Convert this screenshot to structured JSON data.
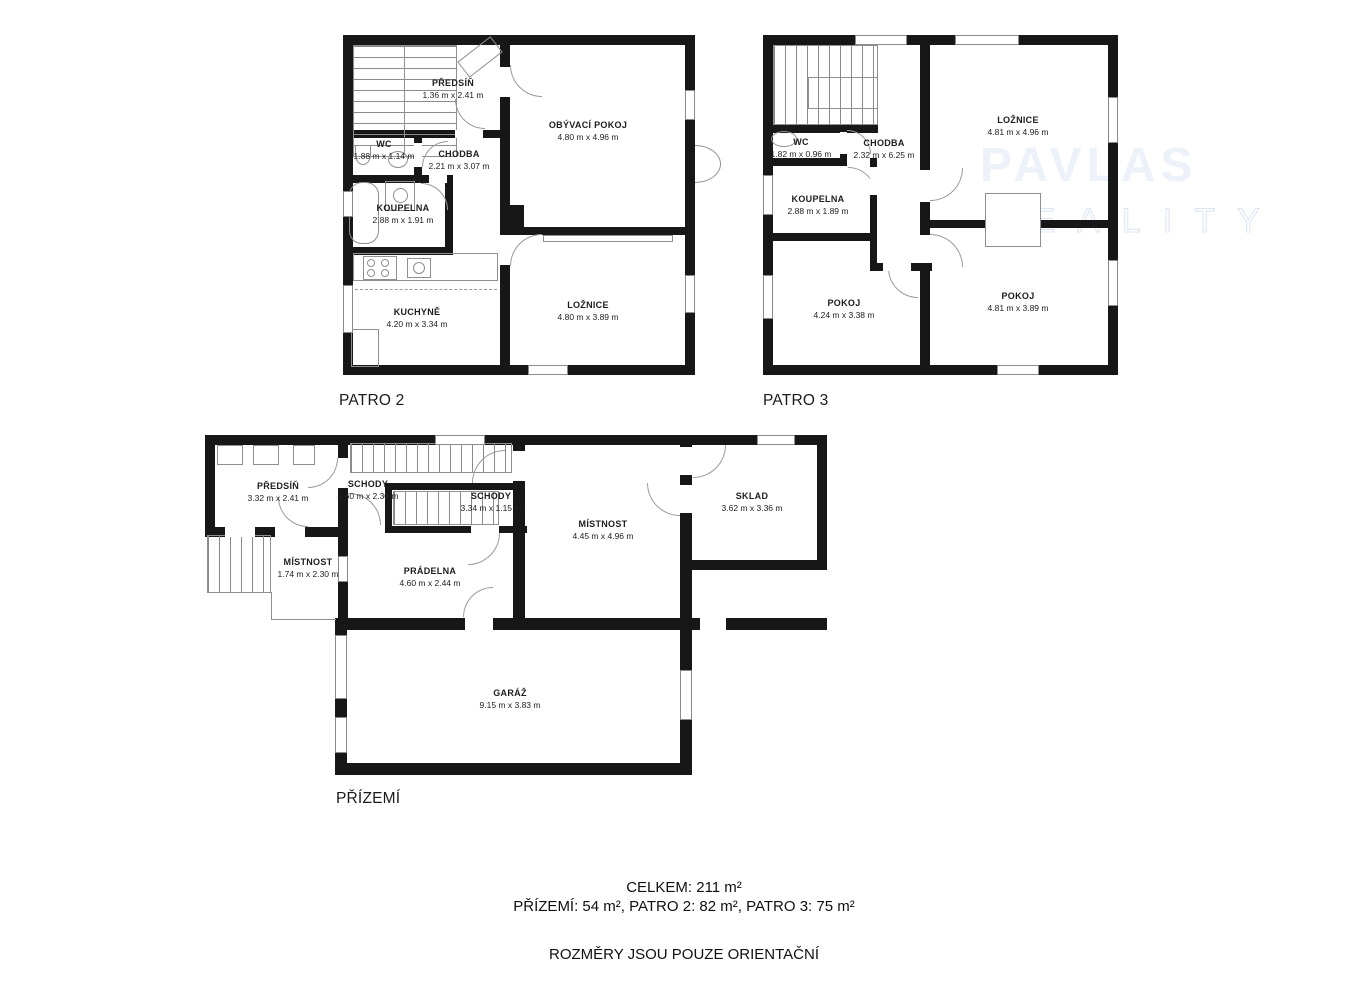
{
  "floors": [
    {
      "label": "PATRO 2",
      "rooms": [
        {
          "name": "PŘEDSÍŇ",
          "dims": "1.36 m x 2.41 m"
        },
        {
          "name": "WC",
          "dims": "1.88 m x 1.14 m"
        },
        {
          "name": "CHODBA",
          "dims": "2.21 m x 3.07 m"
        },
        {
          "name": "KOUPELNA",
          "dims": "2.88 m x 1.91 m"
        },
        {
          "name": "KUCHYNĚ",
          "dims": "4.20 m x 3.34 m"
        },
        {
          "name": "OBÝVACÍ POKOJ",
          "dims": "4.80 m x 4.96 m"
        },
        {
          "name": "LOŽNICE",
          "dims": "4.80 m x 3.89 m"
        }
      ]
    },
    {
      "label": "PATRO 3",
      "rooms": [
        {
          "name": "WC",
          "dims": "1.82 m x 0.96 m"
        },
        {
          "name": "CHODBA",
          "dims": "2.32 m x 6.25 m"
        },
        {
          "name": "KOUPELNA",
          "dims": "2.88 m x 1.89 m"
        },
        {
          "name": "LOŽNICE",
          "dims": "4.81 m x 4.96 m"
        },
        {
          "name": "POKOJ",
          "dims": "4.24 m x 3.38 m"
        },
        {
          "name": "POKOJ",
          "dims": "4.81 m x 3.89 m"
        }
      ]
    },
    {
      "label": "PŘÍZEMÍ",
      "rooms": [
        {
          "name": "PŘEDSÍŇ",
          "dims": "3.32 m x 2.41 m"
        },
        {
          "name": "SCHODY",
          "dims": "4.60 m x 2.30 m"
        },
        {
          "name": "SCHODY",
          "dims": "3.34 m x 1.15 m"
        },
        {
          "name": "MÍSTNOST",
          "dims": "1.74 m x 2.30 m"
        },
        {
          "name": "PRÁDELNA",
          "dims": "4.60 m x 2.44 m"
        },
        {
          "name": "MÍSTNOST",
          "dims": "4.45 m x 4.96 m"
        },
        {
          "name": "SKLAD",
          "dims": "3.62 m x 3.36 m"
        },
        {
          "name": "GARÁŽ",
          "dims": "9.15 m x 3.83 m"
        }
      ]
    }
  ],
  "summary": {
    "line1": "CELKEM: 211 m²",
    "line2": "PŘÍZEMÍ: 54 m², PATRO 2: 82 m², PATRO 3: 75 m²",
    "line3": "ROZMĚRY JSOU POUZE ORIENTAČNÍ"
  },
  "watermark": {
    "line1": "PAVLAS",
    "line2": "REALITY"
  },
  "colors": {
    "wall": "#171717",
    "line": "#8a8a8a",
    "watermark_fill": "#edf1f9",
    "watermark_stroke": "#dbe4f1"
  }
}
